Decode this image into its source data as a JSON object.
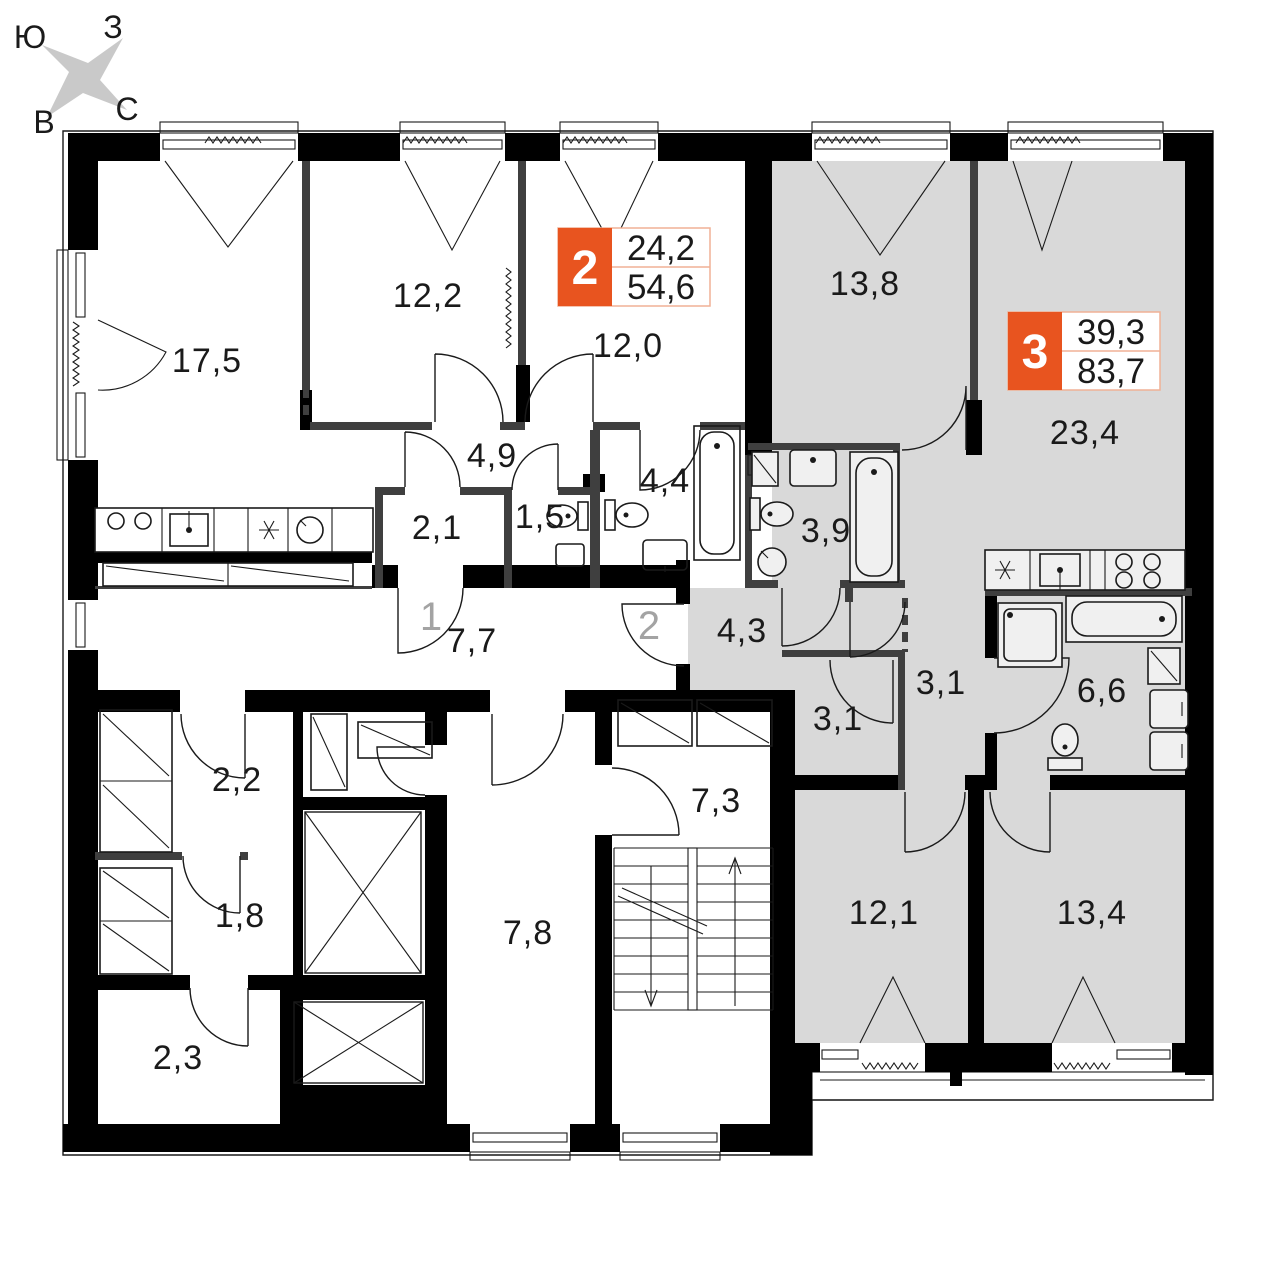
{
  "compass": {
    "south": "Ю",
    "west": "З",
    "north": "С",
    "east": "В"
  },
  "apartments": [
    {
      "number": "2",
      "rooms_area": "24,2",
      "total_area": "54,6"
    },
    {
      "number": "3",
      "rooms_area": "39,3",
      "total_area": "83,7"
    }
  ],
  "entrances": [
    {
      "label": "1"
    },
    {
      "label": "2"
    }
  ],
  "rooms": [
    {
      "type": "living-kitchen",
      "area": "17,5"
    },
    {
      "type": "bedroom",
      "area": "12,2"
    },
    {
      "type": "bedroom",
      "area": "12,0"
    },
    {
      "type": "hallway",
      "area": "4,9"
    },
    {
      "type": "wardrobe",
      "area": "2,1"
    },
    {
      "type": "wc",
      "area": "1,5"
    },
    {
      "type": "bathroom",
      "area": "4,4"
    },
    {
      "type": "corridor",
      "area": "7,7"
    },
    {
      "type": "living-room",
      "area": "13,8"
    },
    {
      "type": "living-kitchen",
      "area": "23,4"
    },
    {
      "type": "bathroom",
      "area": "3,9"
    },
    {
      "type": "entrance-hall",
      "area": "4,3"
    },
    {
      "type": "corridor",
      "area": "3,1"
    },
    {
      "type": "wardrobe",
      "area": "3,1"
    },
    {
      "type": "bathroom",
      "area": "6,6"
    },
    {
      "type": "bedroom",
      "area": "12,1"
    },
    {
      "type": "bedroom",
      "area": "13,4"
    },
    {
      "type": "storeroom",
      "area": "2,2"
    },
    {
      "type": "storeroom",
      "area": "1,8"
    },
    {
      "type": "storeroom",
      "area": "2,3"
    },
    {
      "type": "elevator-lobby",
      "area": "7,8"
    },
    {
      "type": "stairwell",
      "area": "7,3"
    }
  ],
  "colors": {
    "accent": "#e8541f",
    "badge_border": "#f0b195",
    "apartment_fill": "#d9d9d9",
    "wall": "#000000",
    "partition": "#3f3f3f",
    "muted_label": "#a3a3a3"
  }
}
